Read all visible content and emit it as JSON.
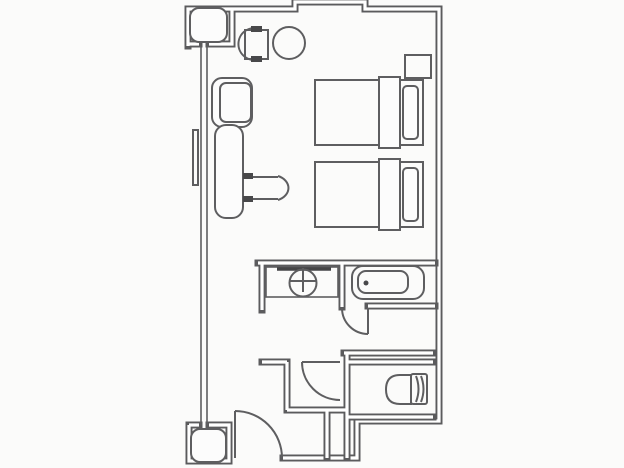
{
  "meta": {
    "label": "Hotel twin room floor plan",
    "background": "#fbfbfa",
    "wall_color": "#5b5b5d",
    "line_color": "#5e5e60",
    "accent_dark": "#454547"
  },
  "rooms": [
    {
      "name": "bedroom"
    },
    {
      "name": "vanity-washroom"
    },
    {
      "name": "bathroom"
    },
    {
      "name": "toilet-room"
    },
    {
      "name": "entry-hall"
    }
  ],
  "fixtures": [
    {
      "name": "twin-bed-1"
    },
    {
      "name": "twin-bed-2"
    },
    {
      "name": "pillow-1"
    },
    {
      "name": "pillow-2"
    },
    {
      "name": "nightstand"
    },
    {
      "name": "armchair"
    },
    {
      "name": "round-table"
    },
    {
      "name": "lounge-chair"
    },
    {
      "name": "desk"
    },
    {
      "name": "desk-chair"
    },
    {
      "name": "vanity-counter"
    },
    {
      "name": "washbasin"
    },
    {
      "name": "mirror"
    },
    {
      "name": "bathtub"
    },
    {
      "name": "toilet"
    },
    {
      "name": "entry-door"
    },
    {
      "name": "washroom-door"
    },
    {
      "name": "bathroom-door"
    },
    {
      "name": "window"
    },
    {
      "name": "pillar-top"
    },
    {
      "name": "pillar-bottom"
    }
  ]
}
